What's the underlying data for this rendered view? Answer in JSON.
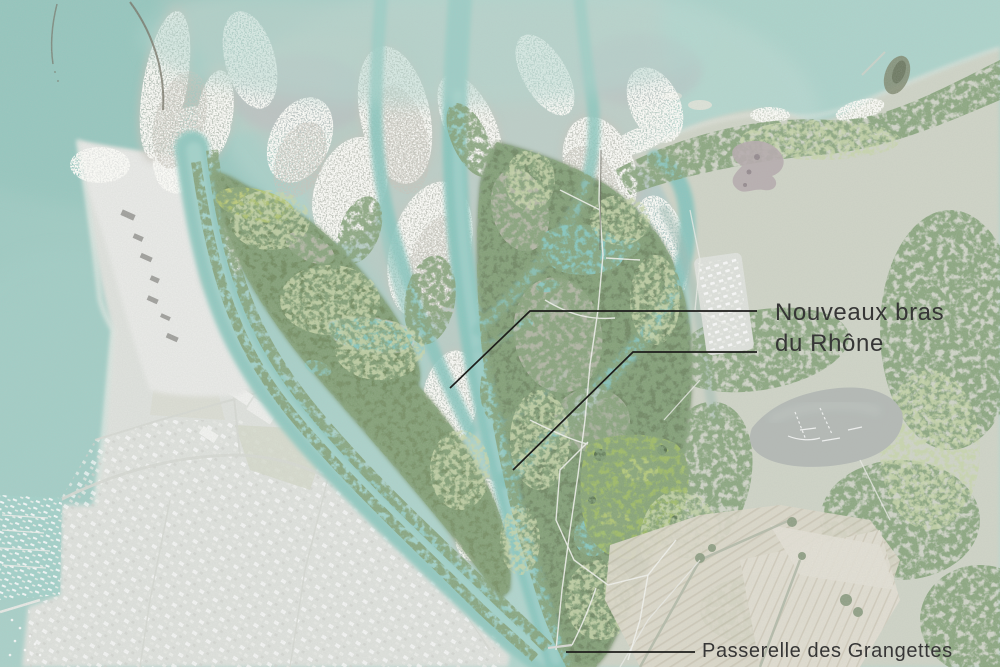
{
  "map": {
    "annotations": {
      "new_branches": {
        "line1": "Nouveaux bras",
        "line2": "du Rhône"
      },
      "footbridge": {
        "label": "Passerelle des Grangettes"
      }
    },
    "colors": {
      "water": "#a6d0c8",
      "water_deep": "#93c6bd",
      "sediment": "#c7c8c1",
      "forest": "#67815a",
      "meadow": "#9dba5e",
      "urban": "#dfe2dd",
      "fields": "#ddd8c9",
      "pond_gray": "#b0b6b2",
      "channel": "#7fc2b9",
      "annotation_line": "#1d1d1b",
      "annotation_text": "#363636"
    }
  }
}
